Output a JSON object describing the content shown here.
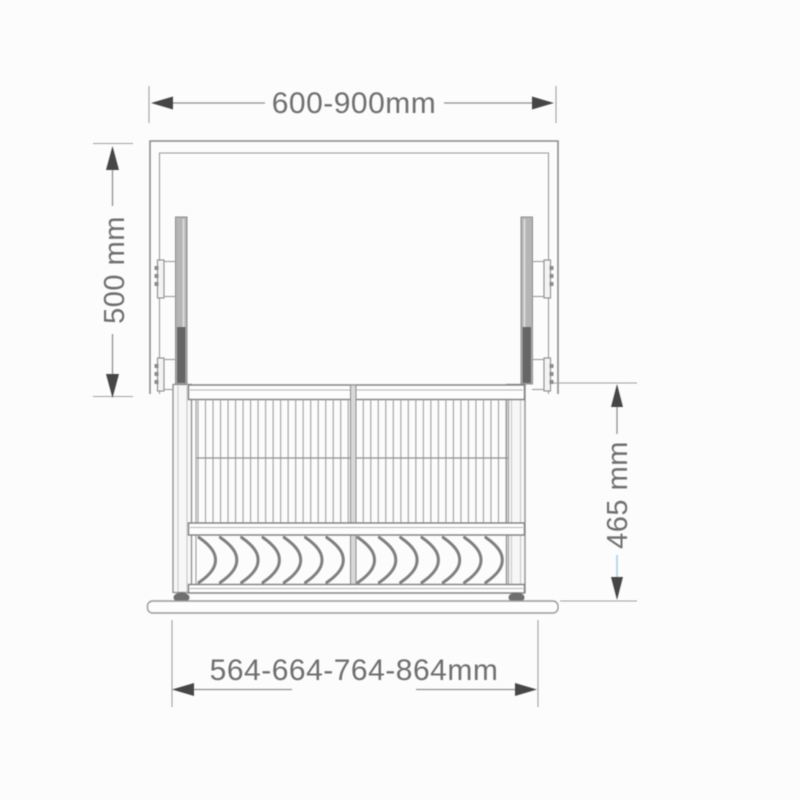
{
  "diagram": {
    "type": "technical-drawing",
    "subject": "pull-down dish rack inside wall cabinet, front elevation",
    "dimensions": {
      "cabinet_width": {
        "label": "600-900mm",
        "orientation": "horizontal",
        "position": "top"
      },
      "cabinet_height": {
        "label": "500 mm",
        "orientation": "vertical",
        "position": "left"
      },
      "rack_height": {
        "label": "465 mm",
        "orientation": "vertical",
        "position": "right"
      },
      "rack_width": {
        "label": "564-664-764-864mm",
        "orientation": "horizontal",
        "position": "bottom"
      }
    },
    "colors": {
      "line": "#8a8a8a",
      "arrow": "#464646",
      "text": "#6f6f6f",
      "rail_fill": "#b5b5b5",
      "rail_dark": "#666666",
      "accent_blue": "#a9cfe2",
      "background": "#fcfcfc"
    },
    "rack": {
      "wire_count": 42,
      "wire_area": {
        "x1": 198,
        "x2": 506,
        "y1": 399.5,
        "y2": 523
      },
      "plate_slot_sections": 2,
      "plate_slots_per_section": 7,
      "chevron": {
        "y": 537.5,
        "height": 45,
        "step": 21.3,
        "section_starts": [
          199,
          358
        ]
      }
    }
  }
}
